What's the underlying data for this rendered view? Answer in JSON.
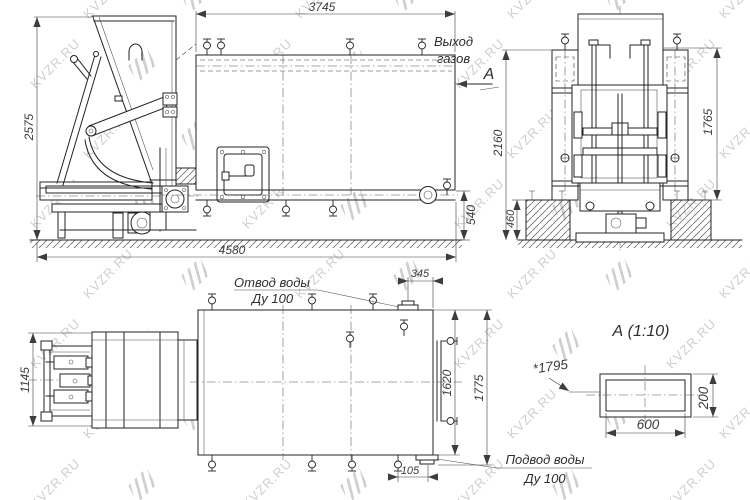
{
  "colors": {
    "line": "#232323",
    "dim_text": "#3b3b3b",
    "watermark": "#c7c7c7",
    "background": "#ffffff"
  },
  "watermark": {
    "text": "KVZR.RU",
    "color": "#c7c7c7"
  },
  "front_view": {
    "dim_top_length": "3745",
    "dim_overall_height": "2575",
    "dim_base_length": "4580",
    "dim_drain_height": "540",
    "gas_outlet_label_line1": "Выход",
    "gas_outlet_label_line2": "газов",
    "section_arrow_label": "А"
  },
  "end_view": {
    "dim_overall_height": "2160",
    "dim_body_height": "1765",
    "dim_foundation_height": "460"
  },
  "plan_view": {
    "dim_tipper_width": "1145",
    "dim_outlet_offset": "345",
    "dim_body_width": "1620",
    "dim_overall_width": "1775",
    "dim_inlet_offset": "105",
    "water_outlet_label_line1": "Отвод воды",
    "water_outlet_label_line2": "Ду 100",
    "water_inlet_label_line1": "Подвод воды",
    "water_inlet_label_line2": "Ду 100"
  },
  "section_view": {
    "title": "А (1:10)",
    "dim_ref_length": "*1795",
    "dim_duct_width": "600",
    "dim_duct_height": "200"
  }
}
